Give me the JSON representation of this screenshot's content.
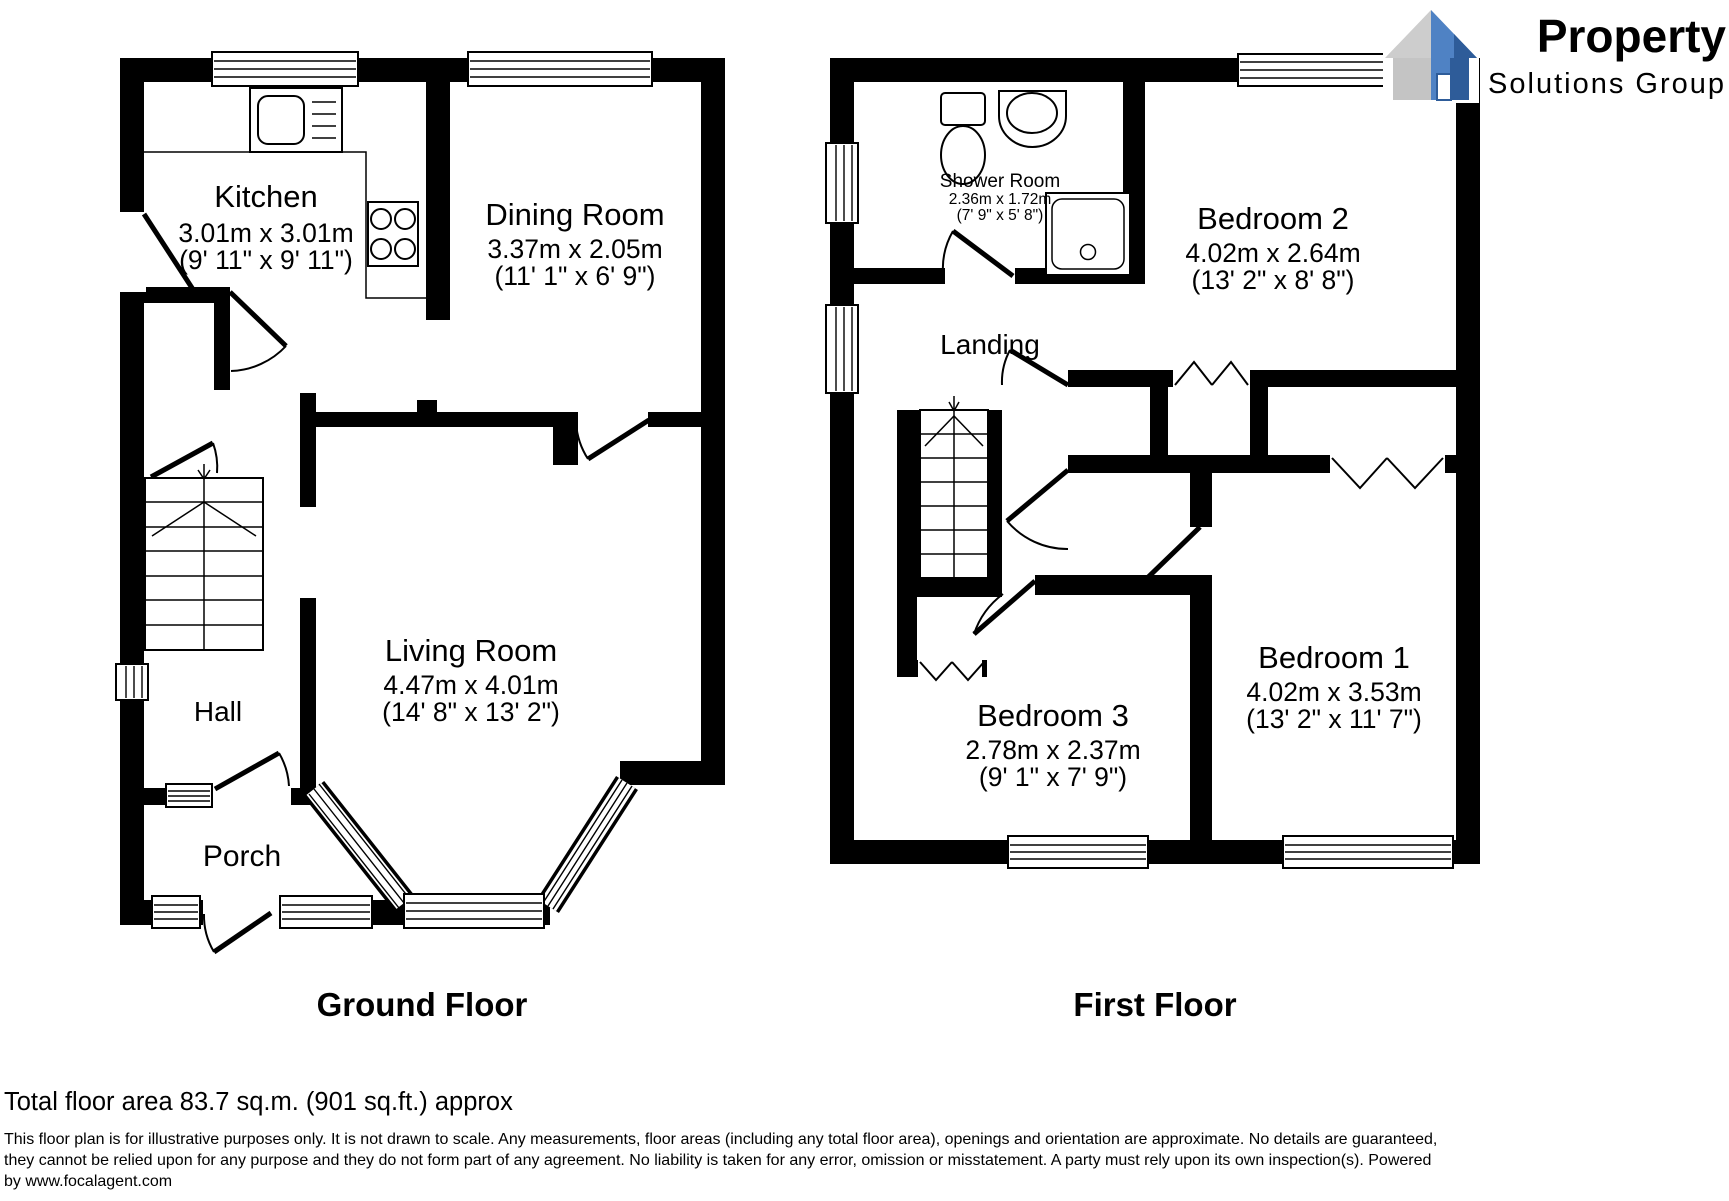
{
  "logo": {
    "brand": "Property",
    "subtitle": "Solutions Group",
    "brand_color": "#3a67ad",
    "subtitle_color": "#8f8f8f"
  },
  "ground": {
    "floor_label": "Ground Floor",
    "rooms": {
      "kitchen": {
        "name": "Kitchen",
        "metric": "3.01m x 3.01m",
        "imperial": "(9' 11\" x 9' 11\")"
      },
      "dining": {
        "name": "Dining Room",
        "metric": "3.37m x 2.05m",
        "imperial": "(11' 1\" x 6' 9\")"
      },
      "living": {
        "name": "Living Room",
        "metric": "4.47m x 4.01m",
        "imperial": "(14' 8\" x 13' 2\")"
      },
      "hall": {
        "name": "Hall"
      },
      "porch": {
        "name": "Porch"
      }
    }
  },
  "first": {
    "floor_label": "First Floor",
    "rooms": {
      "shower": {
        "name": "Shower Room",
        "metric": "2.36m x 1.72m",
        "imperial": "(7' 9\" x 5' 8\")"
      },
      "landing": {
        "name": "Landing"
      },
      "bedroom2": {
        "name": "Bedroom 2",
        "metric": "4.02m x 2.64m",
        "imperial": "(13' 2\" x 8' 8\")"
      },
      "bedroom1": {
        "name": "Bedroom 1",
        "metric": "4.02m x 3.53m",
        "imperial": "(13' 2\" x 11' 7\")"
      },
      "bedroom3": {
        "name": "Bedroom 3",
        "metric": "2.78m x 2.37m",
        "imperial": "(9' 1\" x 7' 9\")"
      }
    }
  },
  "footer": {
    "total_area": "Total floor area 83.7 sq.m. (901 sq.ft.) approx",
    "disclaimer_lines": [
      "This floor plan is for illustrative purposes only. It is not drawn to scale. Any measurements, floor areas (including any total floor area), openings and orientation are approximate. No details are guaranteed,",
      "they cannot be relied upon for any purpose and they do not form part of any agreement. No liability is taken for any error, omission or misstatement. A party must rely upon its own inspection(s). Powered",
      "by www.focalagent.com"
    ]
  },
  "colors": {
    "wall": "#000000"
  }
}
